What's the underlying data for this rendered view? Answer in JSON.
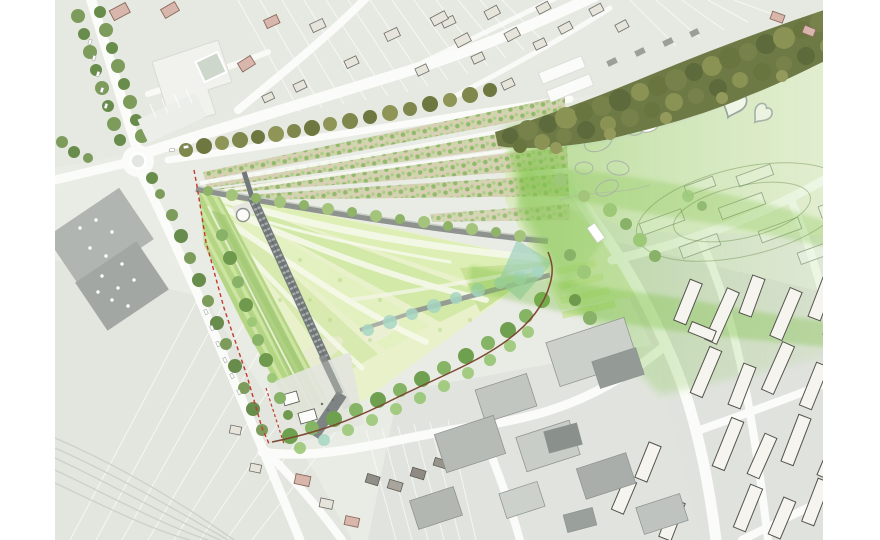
{
  "canvas": {
    "width": 880,
    "height": 540,
    "background": "#ffffff",
    "map_area": {
      "left": 55,
      "right": 823,
      "top": 0,
      "bottom": 540
    }
  },
  "scene": {
    "type": "landscape-masterplan-site-plan",
    "features": [
      {
        "name": "central-park-meadow-triangle",
        "description": "triangular meadow park with fanning mown paths"
      },
      {
        "name": "boardwalk-path",
        "description": "dark linear boardwalk with cross ties crossing the park diagonally"
      },
      {
        "name": "allotment-garden-rows",
        "description": "fanning rows of small garden plots north of the park"
      },
      {
        "name": "riparian-forest-band",
        "description": "dense dark olive tree band along the north-east edge"
      },
      {
        "name": "green-wash-overlay",
        "description": "translucent green landscape corridor flowing east over existing fabric"
      },
      {
        "name": "roundabout",
        "description": "road roundabout at west road junction"
      },
      {
        "name": "tree-lined-avenue",
        "description": "double tree row avenue to the north-west"
      },
      {
        "name": "big-retail-building",
        "description": "large grey flat-roof building with skylights, west side"
      },
      {
        "name": "residential-blocks",
        "description": "rows of elongated housing bars, south-east"
      },
      {
        "name": "industrial-buildings",
        "description": "grey industrial slabs, bottom centre"
      },
      {
        "name": "site-boundary-red-line",
        "description": "red dashed property boundary along the west park edge"
      },
      {
        "name": "brown-trail",
        "description": "winding brown path along the south-east park edge"
      },
      {
        "name": "heart-pond",
        "description": "heart-shaped pond outlines in the north-east meadow"
      },
      {
        "name": "wetland-teal-band",
        "description": "teal wetland vegetation along the south edge"
      }
    ]
  },
  "palette": {
    "paper": "#ffffff",
    "ghost": "#e9ebe5",
    "fieldN": "#e6e9e1",
    "fieldSW": "#e2e6dd",
    "blockground": "#dfe2dd",
    "industground": "#e0e3dd",
    "road": "#fbfcf9",
    "rail": "#c8ccc6",
    "forest": "#6e7a46",
    "meadow": "#e9f1ca",
    "swoosh": "#f5f8e9",
    "strip": "#b3d584",
    "stripe": "#d4e8a9",
    "allotbase": "#d9cfb5",
    "teal": "#a7d6c3",
    "washstrong": "#7cc142",
    "pathdark": "#73787a",
    "band": "#8e938f",
    "plaza": "#7e8384",
    "red": "#c23b2c",
    "brown": "#7c4a33",
    "bldg": "#f5f4ef",
    "bldgline": "#54544d",
    "ghostline": "#9aa096",
    "biggray": "#aaafac",
    "bigdark": "#9fa4a1",
    "pink": "#d9b6ac",
    "pinkline": "#8a6a5e",
    "shed": "#e7e4dc",
    "shedline": "#6f6f68"
  }
}
